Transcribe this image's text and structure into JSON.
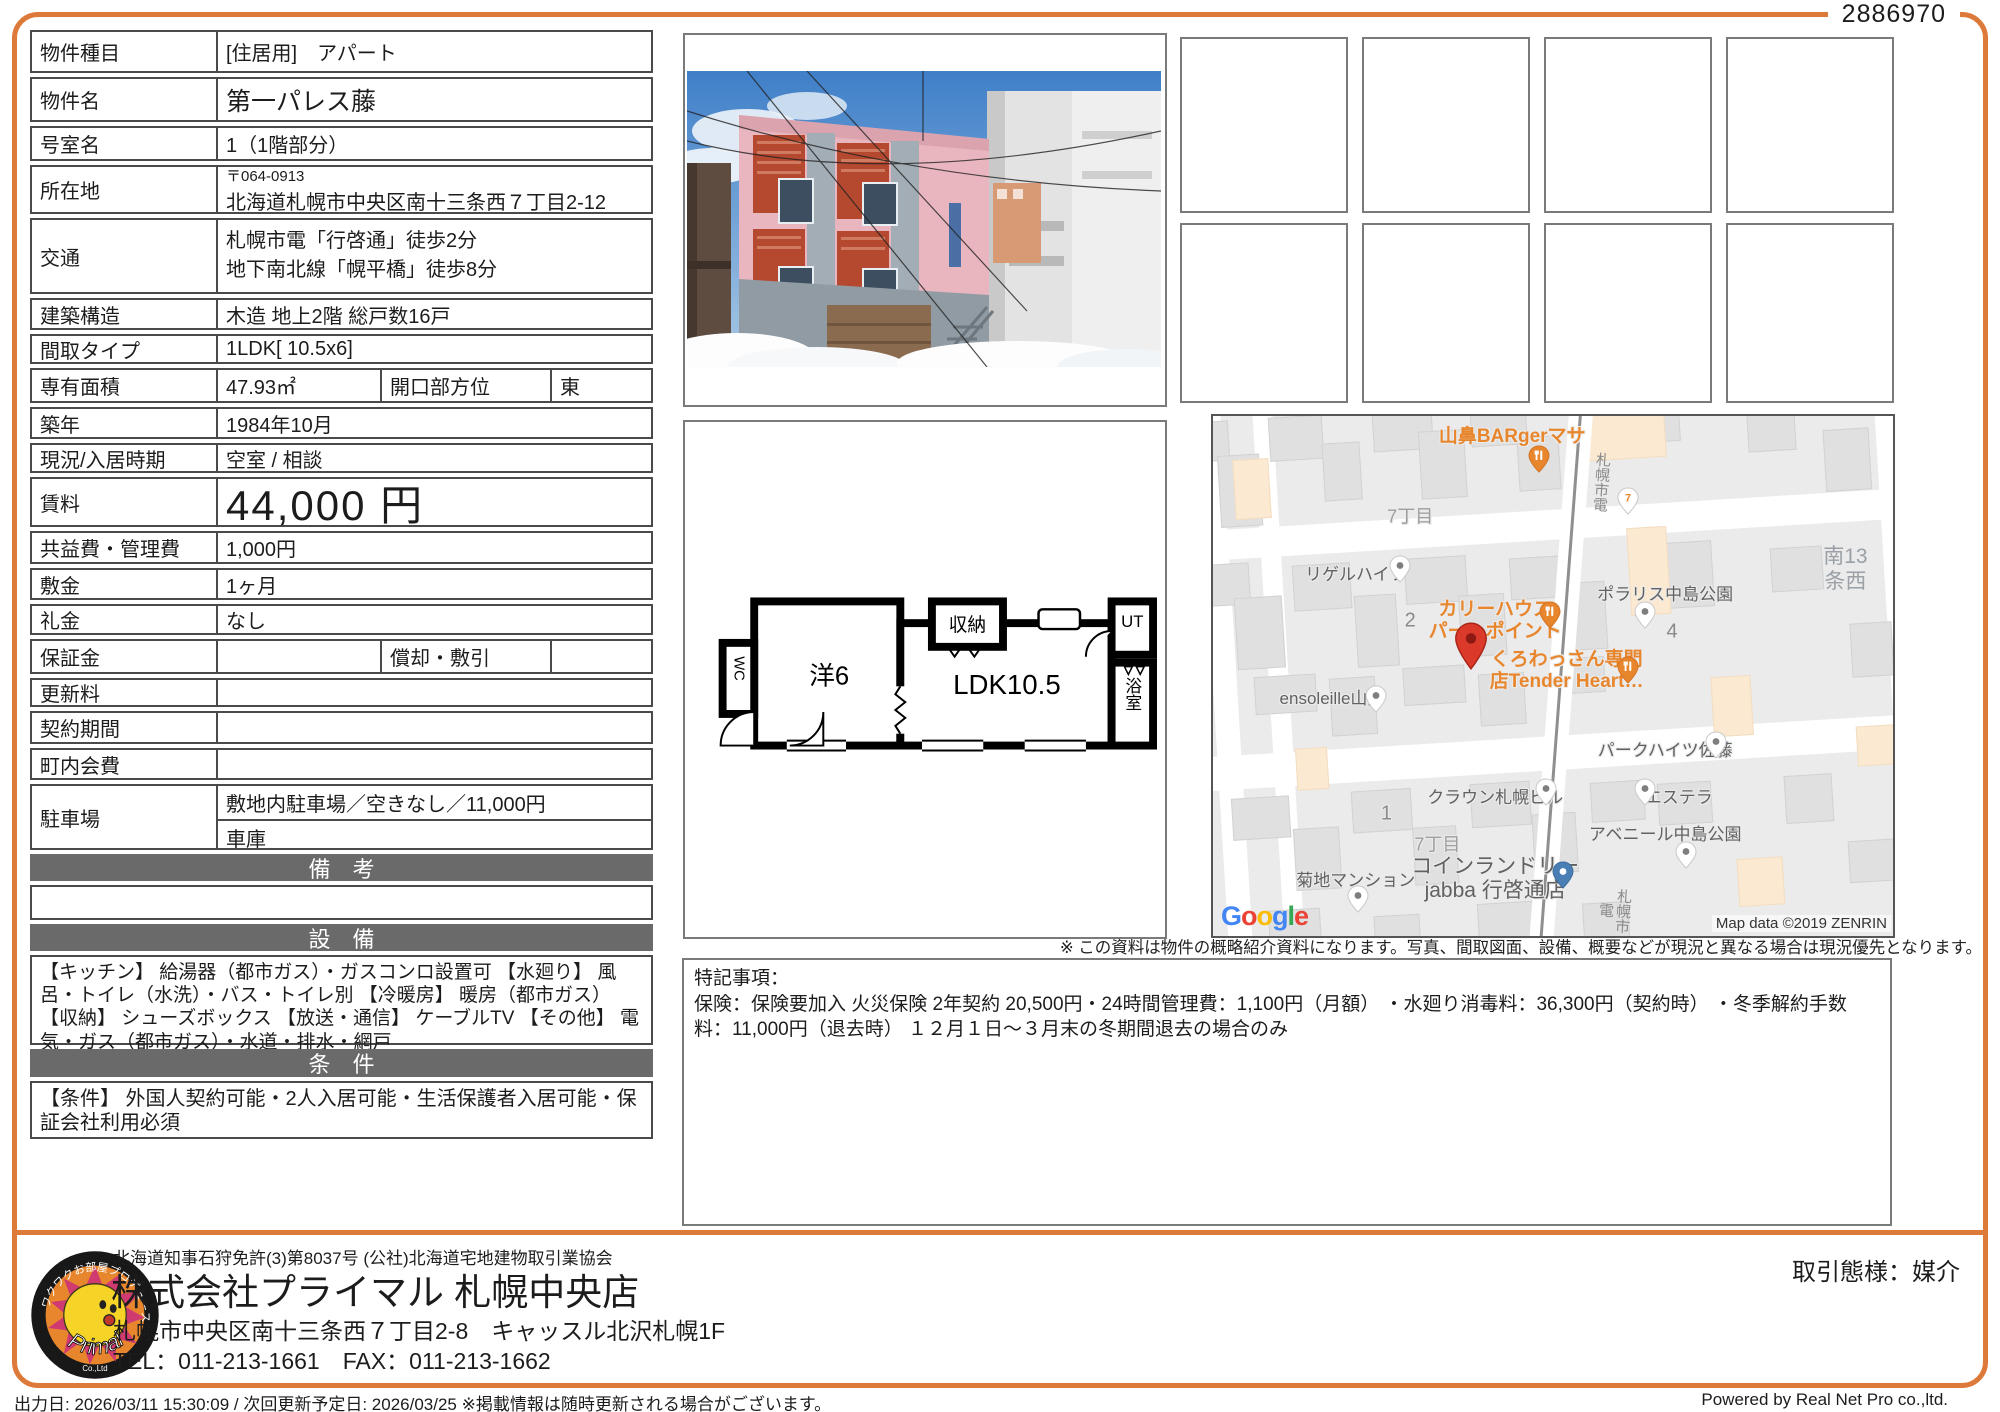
{
  "doc_number": "2886970",
  "table": {
    "type_label": "物件種目",
    "type_value": "[住居用]　アパート",
    "name_label": "物件名",
    "name_value": "第一パレス藤",
    "room_label": "号室名",
    "room_value": "1（1階部分）",
    "address_label": "所在地",
    "address_postal": "〒064-0913",
    "address_value": "北海道札幌市中央区南十三条西７丁目2-12",
    "access_label": "交通",
    "access_line1": "札幌市電「行啓通」徒歩2分",
    "access_line2": "地下南北線「幌平橋」徒歩8分",
    "structure_label": "建築構造",
    "structure_value": "木造 地上2階 総戸数16戸",
    "layout_label": "間取タイプ",
    "layout_value": "1LDK[ 10.5x6]",
    "area_label": "専有面積",
    "area_value": "47.93㎡",
    "opening_label": "開口部方位",
    "opening_value": "東",
    "built_label": "築年",
    "built_value": "1984年10月",
    "status_label": "現況/入居時期",
    "status_value": "空室 / 相談",
    "rent_label": "賃料",
    "rent_value": "44,000 円",
    "fee_label": "共益費・管理費",
    "fee_value": "1,000円",
    "deposit_label": "敷金",
    "deposit_value": "1ヶ月",
    "keymoney_label": "礼金",
    "keymoney_value": "なし",
    "guarantee_label": "保証金",
    "guarantee_value": "",
    "amortization_label": "償却・敷引",
    "amortization_value": "",
    "renewal_label": "更新料",
    "renewal_value": "",
    "contract_label": "契約期間",
    "contract_value": "",
    "chonaikai_label": "町内会費",
    "chonaikai_value": "",
    "parking_label": "駐車場",
    "parking_value1": "敷地内駐車場／空きなし／11,000円",
    "parking_value2": "車庫",
    "section_remarks": "備　考",
    "remarks_body": "",
    "section_equipment": "設　備",
    "equipment_text": "【キッチン】 給湯器（都市ガス）・ガスコンロ設置可 【水廻り】 風呂・トイレ（水洗）・バス・トイレ別 【冷暖房】 暖房（都市ガス） 【収納】 シューズボックス 【放送・通信】 ケーブルTV 【その他】 電気・ガス（都市ガス）・水道・排水・網戸",
    "section_conditions": "条　件",
    "conditions_text": "【条件】 外国人契約可能・2人入居可能・生活保護者入居可能・保証会社利用必須"
  },
  "floor_plan": {
    "room_west": "洋6",
    "room_ldk": "LDK10.5",
    "closet": "収納",
    "wc": "WC",
    "ut": "UT",
    "bath": "浴室"
  },
  "map": {
    "google_letters": [
      "G",
      "o",
      "o",
      "g",
      "l",
      "e"
    ],
    "copyright": "Map data ©2019 ZENRIN",
    "labels": [
      {
        "text": "山鼻BARgerマサ",
        "cls": "m-orange",
        "x": 44,
        "y": 4
      },
      {
        "text": "札幌市電",
        "cls": "m-vroad",
        "x": 57,
        "y": 7
      },
      {
        "text": "7丁目",
        "cls": "m-road",
        "x": 29,
        "y": 19.5
      },
      {
        "text": "リゲルハイツ",
        "cls": "m-gray",
        "x": 21,
        "y": 30.5
      },
      {
        "text": "南13条西",
        "cls": "m-area",
        "x": 93,
        "y": 29.5
      },
      {
        "text": "ポラリス中島公園",
        "cls": "m-gray",
        "x": 66.5,
        "y": 34.5
      },
      {
        "text": "2",
        "cls": "m-block",
        "x": 29,
        "y": 39.5
      },
      {
        "text": "カリーハウス\nパー　ポイント",
        "cls": "m-orange",
        "x": 41.5,
        "y": 39.5
      },
      {
        "text": "くろわっさん専門\n店Tender Heart…",
        "cls": "m-orange",
        "x": 52,
        "y": 49
      },
      {
        "text": "4",
        "cls": "m-block",
        "x": 67.5,
        "y": 41.5
      },
      {
        "text": "ensoleille山鼻",
        "cls": "m-gray",
        "x": 17.5,
        "y": 54.5
      },
      {
        "text": "パークハイツ佐藤",
        "cls": "m-gray",
        "x": 66.5,
        "y": 64.5
      },
      {
        "text": "クラウン札幌ビル",
        "cls": "m-gray",
        "x": 41.5,
        "y": 73.5
      },
      {
        "text": "エステラ",
        "cls": "m-gray",
        "x": 68.5,
        "y": 73.5
      },
      {
        "text": "1",
        "cls": "m-block",
        "x": 25.5,
        "y": 76.5
      },
      {
        "text": "アベニール中島公園",
        "cls": "m-gray",
        "x": 66.5,
        "y": 80.5
      },
      {
        "text": "7丁目",
        "cls": "m-road",
        "x": 33,
        "y": 82.5
      },
      {
        "text": "コインランドリー\njabba 行啓通店",
        "cls": "m-glarge",
        "x": 41.5,
        "y": 89
      },
      {
        "text": "菊地マンション",
        "cls": "m-gray",
        "x": 21,
        "y": 89.5
      },
      {
        "text": "札幌市電",
        "cls": "m-vroad",
        "x": 59,
        "y": 90
      }
    ],
    "pins": [
      {
        "type": "restaurant",
        "x": 48,
        "y": 12
      },
      {
        "type": "seven",
        "x": 61,
        "y": 20
      },
      {
        "type": "white",
        "x": 27.5,
        "y": 33
      },
      {
        "type": "white",
        "x": 63.5,
        "y": 42
      },
      {
        "type": "restaurant",
        "x": 49.5,
        "y": 42
      },
      {
        "type": "restaurant",
        "x": 61,
        "y": 52.5
      },
      {
        "type": "white",
        "x": 24,
        "y": 58
      },
      {
        "type": "white",
        "x": 74,
        "y": 67
      },
      {
        "type": "white",
        "x": 49,
        "y": 76
      },
      {
        "type": "white",
        "x": 63.5,
        "y": 76
      },
      {
        "type": "white",
        "x": 69.5,
        "y": 88
      },
      {
        "type": "laundry",
        "x": 51.5,
        "y": 92
      },
      {
        "type": "white",
        "x": 21.3,
        "y": 96.5
      },
      {
        "type": "target",
        "x": 38,
        "y": 50
      }
    ]
  },
  "disclaimer": "※ この資料は物件の概略紹介資料になります。写真、間取図面、設備、概要などが現況と異なる場合は現況優先となります。",
  "notes": {
    "title": "特記事項：",
    "body": "保険：保険要加入 火災保険 2年契約 20,500円・24時間管理費：1,100円（月額） ・水廻り消毒料：36,300円（契約時） ・冬季解約手数料：11,000円（退去時） １２月１日～３月末の冬期間退去の場合のみ"
  },
  "footer": {
    "license": "北海道知事石狩免許(3)第8037号 (公社)北海道宅地建物取引業協会",
    "company": "株式会社プライマル 札幌中央店",
    "address": "札幌市中央区南十三条西７丁目2-8　キャッスル北沢札幌1F",
    "tel_fax": "TEL：011-213-1661　FAX：011-213-1662",
    "deal_type": "取引態様：媒介",
    "logo_brand": "Primal",
    "logo_sub": "Co.,Ltd",
    "logo_tagline": "ワクワクお部屋プロデュース"
  },
  "bottom": {
    "left": "出力日: 2026/03/11 15:30:09 / 次回更新予定日: 2026/03/25 ※掲載情報は随時更新される場合がございます。",
    "right": "Powered by Real Net Pro co.,ltd."
  }
}
